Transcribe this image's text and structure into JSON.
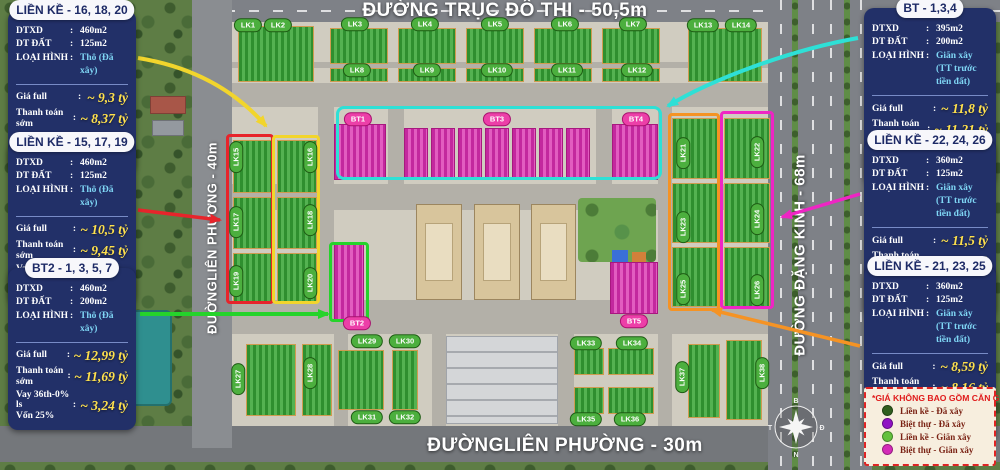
{
  "roads": {
    "top": "ĐƯỜNG TRỤC ĐÔ THỊ - 50,5m",
    "bottom": "ĐƯỜNGLIÊN PHƯỜNG - 30m",
    "left": "ĐƯỜNGLIÊN PHƯƠNG - 40m",
    "right": "ĐƯỜNG ĐẶNG KINH - 68m"
  },
  "compass": {
    "north": "B",
    "east": "Đ",
    "south": "N",
    "west": "T"
  },
  "blocks": {
    "lk": [
      "LK1",
      "LK2",
      "LK3",
      "LK4",
      "LK5",
      "LK6",
      "LK7",
      "LK8",
      "LK9",
      "LK10",
      "LK11",
      "LK12",
      "LK13",
      "LK14",
      "LK15",
      "LK16",
      "LK17",
      "LK18",
      "LK19",
      "LK20",
      "LK21",
      "LK22",
      "LK23",
      "LK24",
      "LK25",
      "LK26",
      "LK27",
      "LK28",
      "LK29",
      "LK30",
      "LK31",
      "LK32",
      "LK33",
      "LK34",
      "LK35",
      "LK36",
      "LK37",
      "LK38"
    ],
    "bt": [
      "BT1",
      "BT2",
      "BT3",
      "BT4",
      "BT5"
    ]
  },
  "cards": [
    {
      "title": "LIỀN KỀ - 16, 18, 20",
      "specs": [
        {
          "label": "DTXD",
          "value": "460m2"
        },
        {
          "label": "DT ĐẤT",
          "value": "125m2"
        },
        {
          "label": "LOẠI HÌNH",
          "value": "Thô (Đã xây)"
        }
      ],
      "prices": [
        {
          "label": "Giá full",
          "value": "~ 9,3 tỷ"
        },
        {
          "label": "Thanh toán sớm",
          "value": "~ 8,37 tỷ"
        },
        {
          "label": "Vay 36th-0% ls",
          "label2": "Vốn 25%",
          "value": "~ 2,32 tỷ"
        }
      ]
    },
    {
      "title": "LIỀN KỀ - 15, 17, 19",
      "specs": [
        {
          "label": "DTXD",
          "value": "460m2"
        },
        {
          "label": "DT ĐẤT",
          "value": "125m2"
        },
        {
          "label": "LOẠI HÌNH",
          "value": "Thô (Đã xây)"
        }
      ],
      "prices": [
        {
          "label": "Giá full",
          "value": "~ 10,5 tỷ"
        },
        {
          "label": "Thanh toán sớm",
          "value": "~ 9,45 tỷ"
        },
        {
          "label": "Vay 36th-0% ls",
          "label2": "Vốn 25%",
          "value": "~ 2,62 tỷ"
        }
      ]
    },
    {
      "title": "BT2 - 1, 3, 5, 7",
      "specs": [
        {
          "label": "DTXD",
          "value": "460m2"
        },
        {
          "label": "DT ĐẤT",
          "value": "200m2"
        },
        {
          "label": "LOẠI HÌNH",
          "value": "Thô (Đã xây)"
        }
      ],
      "prices": [
        {
          "label": "Giá full",
          "value": "~ 12,99 tỷ"
        },
        {
          "label": "Thanh toán sớm",
          "value": "~ 11,69 tỷ"
        },
        {
          "label": "Vay 36th-0% ls",
          "label2": "Vốn 25%",
          "value": "~ 3,24 tỷ"
        }
      ]
    },
    {
      "title": "BT - 1,3,4",
      "specs": [
        {
          "label": "DTXD",
          "value": "395m2"
        },
        {
          "label": "DT ĐẤT",
          "value": "200m2"
        },
        {
          "label": "LOẠI HÌNH",
          "value": "Giãn xây",
          "value2": "(TT trước tiền đất)"
        }
      ],
      "prices": [
        {
          "label": "Giá full",
          "value": "~ 11,8 tỷ"
        },
        {
          "label": "Thanh toán sớm",
          "value": "~ 11,21 tỷ"
        },
        {
          "label": "Vay 36th-0% ls",
          "label2": "Vốn 25%",
          "value": "~ 2,95 tỷ"
        }
      ]
    },
    {
      "title": "LIỀN KỀ - 22, 24, 26",
      "specs": [
        {
          "label": "DTXD",
          "value": "360m2"
        },
        {
          "label": "DT ĐẤT",
          "value": "125m2"
        },
        {
          "label": "LOẠI HÌNH",
          "value": "Giãn xây",
          "value2": "(TT trước tiền đất)"
        }
      ],
      "prices": [
        {
          "label": "Giá full",
          "value": "~ 11,5 tỷ"
        },
        {
          "label": "Thanh toán sớm",
          "value": "~ 10,92 tỷ"
        },
        {
          "label": "Vay 36th-0% ls",
          "label2": "Vốn 25%",
          "value": "~ 2,87 tỷ"
        }
      ]
    },
    {
      "title": "LIỀN KỀ - 21, 23, 25",
      "specs": [
        {
          "label": "DTXD",
          "value": "360m2"
        },
        {
          "label": "DT ĐẤT",
          "value": "125m2"
        },
        {
          "label": "LOẠI HÌNH",
          "value": "Giãn xây",
          "value2": "(TT trước tiền đất)"
        }
      ],
      "prices": [
        {
          "label": "Giá full",
          "value": "~ 8,59 tỷ"
        },
        {
          "label": "Thanh toán sớm",
          "value": "~ 8,16 tỷ"
        },
        {
          "label": "Vay 36th-0% ls",
          "label2": "Vốn 25%",
          "value": "~ 2,14 tỷ"
        }
      ]
    }
  ],
  "legend": {
    "note": "*GIÁ KHÔNG BAO GỒM CĂN GÓC",
    "items": [
      {
        "label": "Liền kề - Đã xây",
        "color": "#2f5e1f"
      },
      {
        "label": "Biệt thự - Đã xây",
        "color": "#9012c4"
      },
      {
        "label": "Liền kề - Giãn xây",
        "color": "#63c13e"
      },
      {
        "label": "Biệt thự - Giãn xây",
        "color": "#d42bb8"
      }
    ]
  },
  "colors": {
    "card_bg": "#223068",
    "price_value": "#ffe14d",
    "spec_accent": "#7fd6f5",
    "highlight_yellow": "#f2d52c",
    "highlight_red": "#e7242b",
    "highlight_green": "#25d32b",
    "highlight_cyan": "#2ee0d6",
    "highlight_orange": "#f59324",
    "highlight_magenta": "#ef25c4"
  }
}
